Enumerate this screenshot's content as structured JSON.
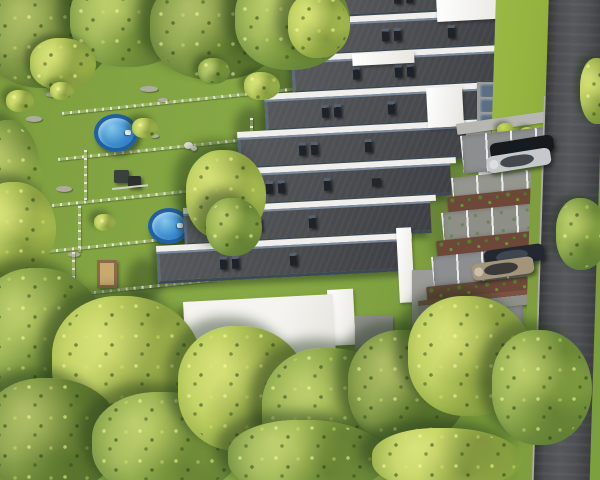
{
  "scene": {
    "title": "Aerial 3D visualization of a terraced housing estate with gardens, pools, parking bays and access road",
    "palette": {
      "grass": "#7f9f3f",
      "lawn_bright": "#93b23e",
      "tree_yellow": "#b6ca56",
      "tree_green": "#8aa845",
      "tree_olive": "#74903a",
      "roof_dark": "#4a4c50",
      "roof_parapet_blue": "#5c6b7d",
      "wall_white": "#f0efeb",
      "wall_gray": "#9b9b97",
      "pavement": "#8c8e90",
      "paver_green": "#8e9088",
      "mulch_brown": "#6d4839",
      "shrub_green": "#55812f",
      "road_asphalt": "#4b4d50",
      "kerb_light": "#aeaea8",
      "sidewalk": "#b7b7b1",
      "pool_rim_blue": "#2060a2",
      "pool_water_blue": "#3c8ccc",
      "fence_light": "#e6e6d6",
      "brick_red": "#7c5242",
      "sand_tan": "#caa96f"
    },
    "buildings": {
      "terraced_units": 8,
      "roof_style": "flat dark membrane, white parapet band, blue-gray edge trim",
      "roof_vents": 24,
      "white_end_walls": 7,
      "bin_enclosure_lids": 3,
      "white_terrace_block": 1
    },
    "gardens": {
      "fenced_rows": 5,
      "pools": [
        {
          "name": "above-ground-pool-upper",
          "shape": "round"
        },
        {
          "name": "above-ground-pool-lower",
          "shape": "round"
        }
      ],
      "playground_panels": 2,
      "sandbox_count": 1,
      "white_dog": 1,
      "rock_clusters": 10
    },
    "parking": {
      "stall_rows": 4,
      "planting_strips": 3,
      "hedge_balls": 3,
      "cars": [
        {
          "name": "black-suv",
          "color": "#17191c"
        },
        {
          "name": "silver-hatchback",
          "color": "#c6c9cc"
        },
        {
          "name": "dark-navy-suv",
          "color": "#232730"
        },
        {
          "name": "champagne-crossover",
          "color": "#a3957a"
        },
        {
          "name": "white-hatchback",
          "color": "#e9ecee"
        }
      ]
    },
    "road": {
      "position": "right edge, top to bottom",
      "lanes": 1
    },
    "vegetation": {
      "large_trees": 23,
      "small_bushes": 6
    }
  }
}
